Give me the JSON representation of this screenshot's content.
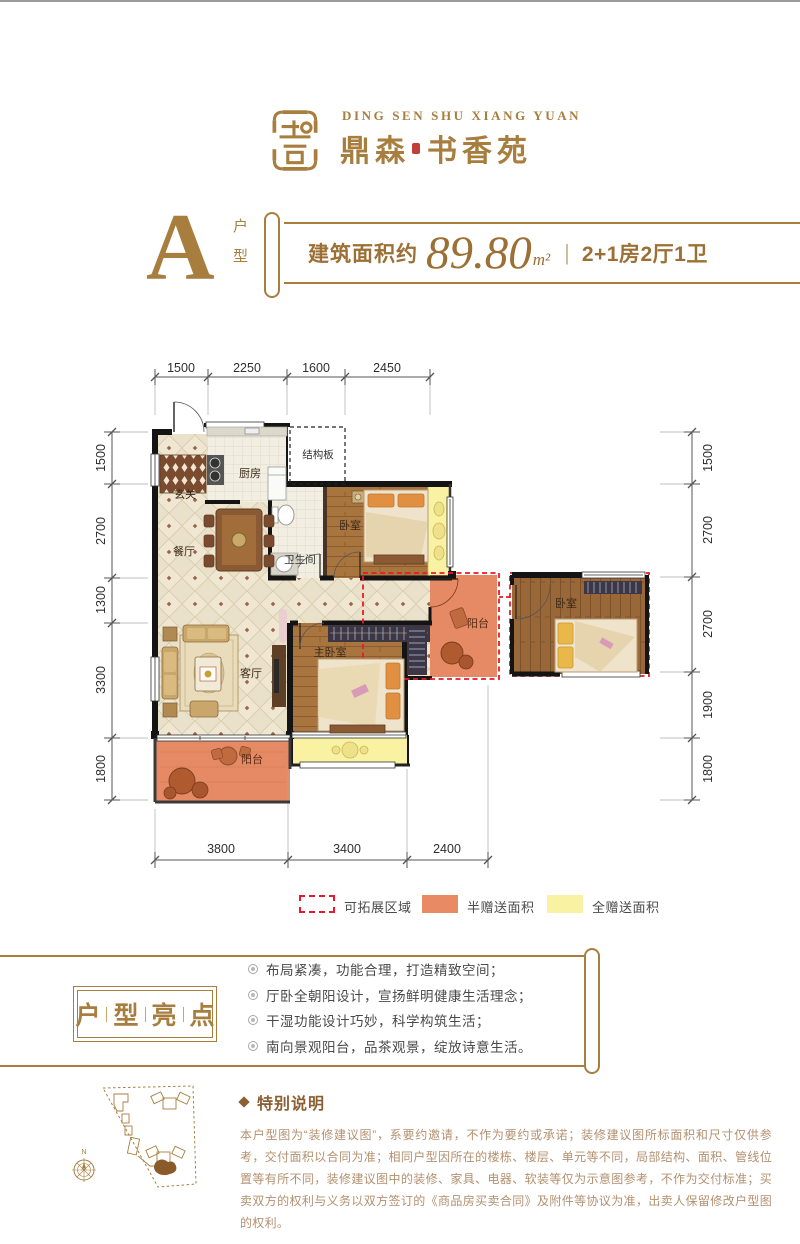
{
  "brand": {
    "name_en": "DING SEN SHU XIANG YUAN",
    "name_cn_left": "鼎森",
    "name_cn_right": "书香苑"
  },
  "header": {
    "unit_letter": "A",
    "unit_label_top": "户",
    "unit_label_bottom": "型",
    "area_prefix": "建筑面积约",
    "area_value": "89.80",
    "area_unit": "m²",
    "divider": "|",
    "layout": "2+1房2厅1卫"
  },
  "floorplan": {
    "dims_top": [
      "1500",
      "2250",
      "1600",
      "2450"
    ],
    "dims_left": [
      "1500",
      "2700",
      "1300",
      "3300",
      "1800"
    ],
    "dims_right": [
      "1500",
      "2700",
      "2700",
      "1900",
      "1800"
    ],
    "dims_bottom": [
      "3800",
      "3400",
      "2400"
    ],
    "rooms": {
      "entry": "玄关",
      "kitchen": "厨房",
      "structure": "结构板",
      "dining": "餐厅",
      "bath": "卫生间",
      "bedroom2": "卧室",
      "living": "客厅",
      "master": "主卧室",
      "balcony_south": "阳台",
      "balcony_mid": "阳台",
      "bedroom3": "卧室"
    }
  },
  "legend": {
    "expand": "可拓展区域",
    "half_gift": "半赠送面积",
    "full_gift": "全赠送面积"
  },
  "highlights": {
    "chars": [
      "户",
      "型",
      "亮",
      "点"
    ],
    "items": [
      "布局紧凑，功能合理，打造精致空间；",
      "厅卧全朝阳设计，宣扬鲜明健康生活理念；",
      "干湿功能设计巧妙，科学构筑生活；",
      "南向景观阳台，品茶观景，绽放诗意生活。"
    ]
  },
  "notes": {
    "title": "特别说明",
    "body": "本户型图为“装修建议图”，系要约邀请，不作为要约或承诺；装修建议图所标面积和尺寸仅供参考，交付面积以合同为准；相同户型因所在的楼栋、楼层、单元等不同，局部结构、面积、管线位置等有所不同，装修建议图中的装修、家具、电器、软装等仅为示意图参考，不作为交付标准；买卖双方的权利与义务以双方签订的《商品房买卖合同》及附件等协议为准，出卖人保留修改户型图的权利。"
  },
  "sitemap": {
    "north": "N"
  },
  "colors": {
    "brand": "#A87E3F",
    "text_brown": "#9C6F35",
    "red_dash": "#E8192C",
    "half_gift": "#E88A64",
    "full_gift": "#F8F2A2"
  }
}
